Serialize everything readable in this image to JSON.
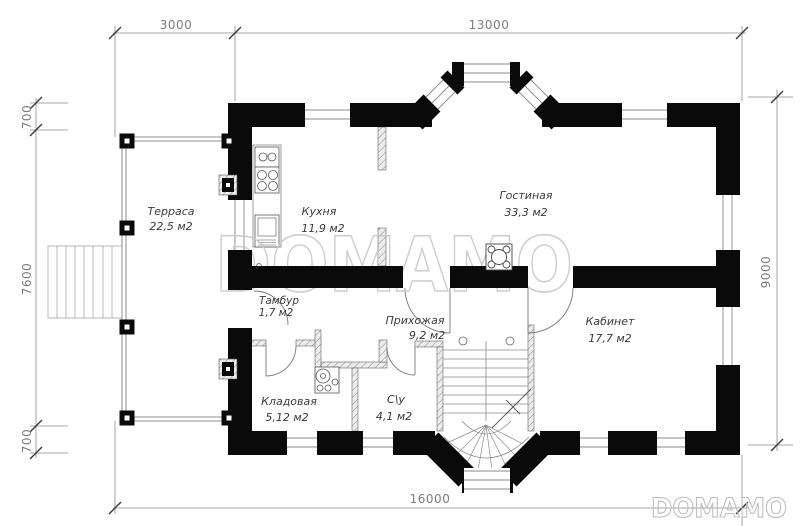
{
  "plan": {
    "rooms": [
      {
        "name": "Терраса",
        "area": "22,5 м2"
      },
      {
        "name": "Кухня",
        "area": "11,9 м2"
      },
      {
        "name": "Гостиная",
        "area": "33,3 м2"
      },
      {
        "name": "Тамбур",
        "area": "1,7 м2"
      },
      {
        "name": "Прихожая",
        "area": "9,2 м2"
      },
      {
        "name": "Кабинет",
        "area": "17,7 м2"
      },
      {
        "name": "Кладовая",
        "area": "5,12 м2"
      },
      {
        "name": "С\\у",
        "area": "4,1 м2"
      }
    ],
    "dimensions": {
      "top_left": "3000",
      "top_right": "13000",
      "left_top": "700",
      "left_middle": "7600",
      "left_bottom": "700",
      "right": "9000",
      "bottom": "16000"
    },
    "watermark": {
      "center": "DOMAMO",
      "corner": "DOMAMO"
    },
    "colors": {
      "wall": "#0a0a0a",
      "dimension": "#8a8a8a",
      "label": "#3a3a3a",
      "watermark": "#c9c9c9"
    }
  }
}
